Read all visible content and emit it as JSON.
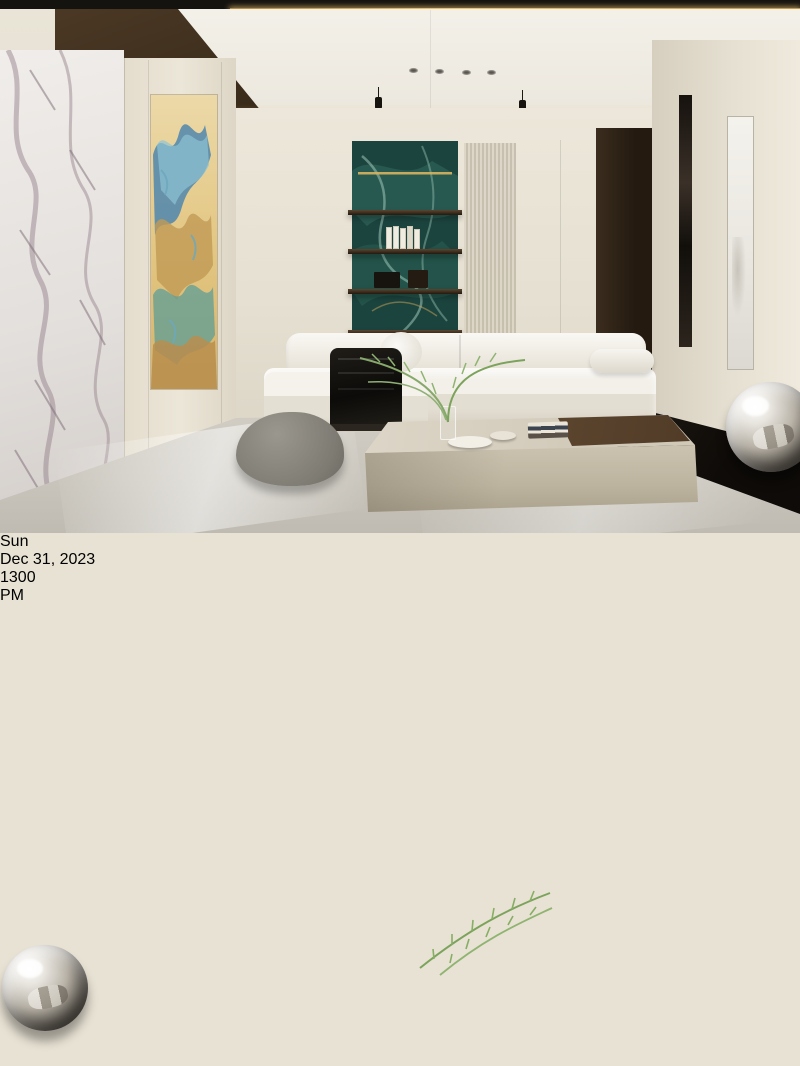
{
  "clock": {
    "day": "Sun",
    "date": "Dec 31, 2023",
    "hour": "13",
    "minute": "00",
    "meridiem": "PM"
  },
  "colors": {
    "wood-dark": "#31251a",
    "wood-mid": "#4a3827",
    "gold-led": "#d9a648",
    "cream": "#e8e2d4",
    "cream-dark": "#d8d1c1",
    "niche-black": "#0d0b09",
    "screen-black": "#040404",
    "clock-white": "#f8f8f8",
    "slat-light": "#6e5640",
    "slat-dark": "#4c3a28",
    "walnut": "#3f2e1f",
    "travertine": "#c6bcab",
    "passage-gray": "#514f55",
    "chair-brown": "#8a5c3e",
    "stool-orange": "#b56a3e",
    "plant-green": "#7ca35c",
    "gold-art": "#dcbd7a"
  }
}
